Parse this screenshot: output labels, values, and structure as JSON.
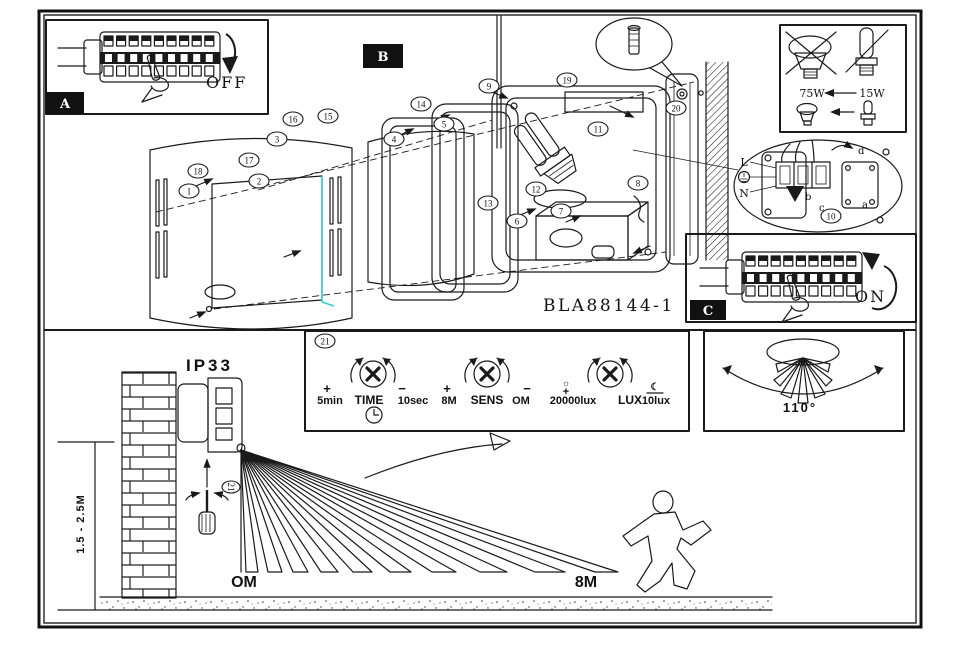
{
  "model": "BLA88144-1",
  "accent_color": "#3ec9d6",
  "panels": {
    "off": {
      "badge": "A",
      "label": "OFF"
    },
    "on": {
      "badge": "C",
      "label": "ON"
    },
    "section_b_badge": "B"
  },
  "bulb_box": {
    "old_watt": "75W",
    "new_watt": "15W"
  },
  "wiring": {
    "live": "L",
    "neutral": "N",
    "term_a": "a",
    "term_b": "b",
    "term_c": "c",
    "term_d": "d"
  },
  "exploded": {
    "callouts": [
      {
        "n": "1",
        "x": 189,
        "y": 191
      },
      {
        "n": "2",
        "x": 259,
        "y": 181
      },
      {
        "n": "3",
        "x": 277,
        "y": 139
      },
      {
        "n": "4",
        "x": 394,
        "y": 139
      },
      {
        "n": "5",
        "x": 444,
        "y": 124
      },
      {
        "n": "6",
        "x": 517,
        "y": 221
      },
      {
        "n": "7",
        "x": 561,
        "y": 211
      },
      {
        "n": "8",
        "x": 638,
        "y": 183
      },
      {
        "n": "9",
        "x": 489,
        "y": 86
      },
      {
        "n": "10",
        "x": 831,
        "y": 216
      },
      {
        "n": "11",
        "x": 598,
        "y": 129
      },
      {
        "n": "12",
        "x": 536,
        "y": 189
      },
      {
        "n": "13",
        "x": 488,
        "y": 203
      },
      {
        "n": "14",
        "x": 421,
        "y": 104
      },
      {
        "n": "15",
        "x": 328,
        "y": 116
      },
      {
        "n": "16",
        "x": 293,
        "y": 119
      },
      {
        "n": "17",
        "x": 249,
        "y": 160
      },
      {
        "n": "18",
        "x": 198,
        "y": 171
      },
      {
        "n": "19",
        "x": 567,
        "y": 80
      },
      {
        "n": "20",
        "x": 676,
        "y": 108
      }
    ]
  },
  "install": {
    "ip_rating": "IP33",
    "mount_height": "1.5 - 2.5M",
    "range_near": "OM",
    "range_far": "8M",
    "tool_callout": "21"
  },
  "settings": {
    "callout": "21",
    "time": {
      "plus": "+",
      "min": "5min",
      "name": "TIME",
      "minus": "−",
      "max": "10sec"
    },
    "sens": {
      "plus": "+",
      "max": "8M",
      "name": "SENS",
      "minus": "−",
      "min": "OM"
    },
    "lux": {
      "sun": "☼",
      "plus": "+",
      "max": "20000lux",
      "name": "LUX",
      "moon": "☾",
      "min": "10lux"
    }
  },
  "angle_box": {
    "angle": "110°"
  }
}
